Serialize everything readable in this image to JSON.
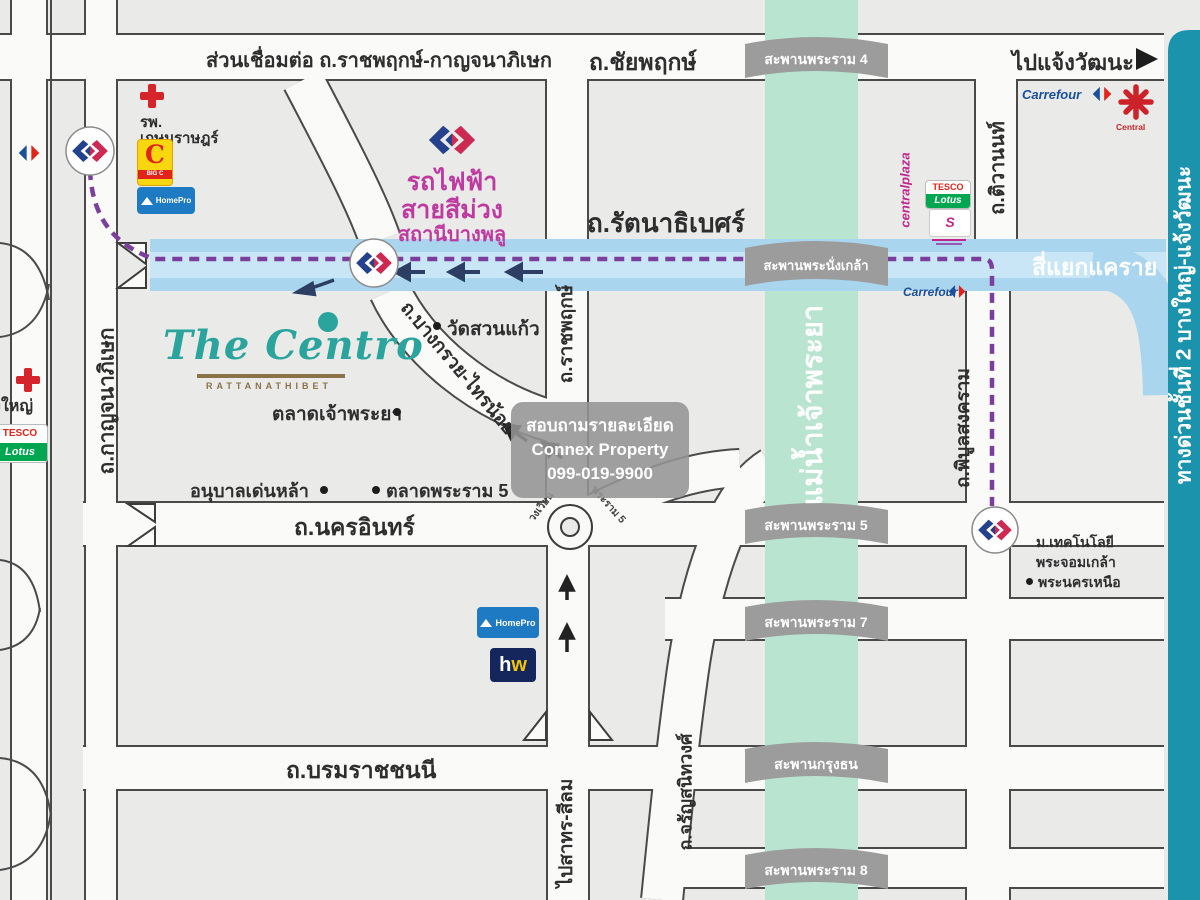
{
  "colors": {
    "river": "#b9e4d0",
    "expressway_band": "#1b93ad",
    "highway_blue": "#a9d5ee",
    "mrt_purple_line": "#7c3e9d",
    "mrt_logo_navy": "#24418e",
    "mrt_logo_red": "#cc2a52",
    "transit_text_magenta": "#bf3aa0",
    "bridge_banner_gray": "#9c9c9c",
    "centro_teal": "#2aa49c",
    "centro_brown": "#8a7248"
  },
  "roads": {
    "connector": "ส่วนเชื่อมต่อ ถ.ราชพฤกษ์-กาญจนาภิเษก",
    "chaiyaphruek": "ถ.ชัยพฤกษ์",
    "to_chaengwattana": "ไปแจ้งวัฒนะ",
    "rattanathibet": "ถ.รัตนาธิเบศร์",
    "tiwanon": "ถ.ติวานนท์",
    "kanchanaphisek": "ถ.กาญจนาภิเษก",
    "ratchaphruek": "ถ.ราชพฤกษ์",
    "bangkruai_sainoi": "ถ.บางกรวย-ไทรน้อย",
    "nakhon_in": "ถ.นครอินทร์",
    "borommaratchachonnani": "ถ.บรมราชชนนี",
    "to_sathorn_silom": "ไปสาทร-สีลม",
    "charansanitwong": "ถ.จรัญสนิทวงศ์",
    "phibunsongkhram": "ถ.พิบูลสงคราม",
    "khae_rai": "สี่แยกแคราย",
    "expressway": "ทางด่วนชั้นที่ 2 บางใหญ่-แจ้งวัฒนะ",
    "river": "แม่น้ำเจ้าพระยา"
  },
  "bridges": {
    "rama4": "สะพานพระราม 4",
    "phranangklao": "สะพานพระนั่งเกล้า",
    "rama5": "สะพานพระราม 5",
    "rama7": "สะพานพระราม 7",
    "krungthon": "สะพานกรุงธน",
    "rama8": "สะพานพระราม 8"
  },
  "transit": {
    "line_name_1": "รถไฟฟ้า",
    "line_name_2": "สายสีม่วง",
    "station": "สถานีบางพลู"
  },
  "project": {
    "name": "The Centro",
    "subtitle": "RATTANATHIBET"
  },
  "places": {
    "kasemrad_1": "รพ.",
    "kasemrad_2": "เกษมราษฎร์",
    "bang_yai": "บางใหญ่",
    "wat_suan_kaew": "วัดสวนแก้ว",
    "talad_chaophraya": "ตลาดเจ้าพระยา",
    "anuban_denla": "อนุบาลเด่นหล้า",
    "talad_rama5": "ตลาดพระราม 5",
    "roundabout_1": "วงเวียน",
    "roundabout_2": "พระราม 5",
    "university_1": "ม.เทคโนโลยี",
    "university_2": "พระจอมเกล้า",
    "university_3": "พระนครเหนือ"
  },
  "logos": {
    "carrefour": "Carrefour",
    "central": "Central",
    "centralplaza": "centralplaza",
    "tesco_1": "TESCO",
    "tesco_2": "Lotus",
    "bigc": "C",
    "bigc_sub": "BIG C",
    "homepro": "HomePro",
    "homeworks_h": "h",
    "homeworks_w": "w"
  },
  "watermark": {
    "line1": "สอบถามรายละเอียด",
    "line2": "Connex Property",
    "line3": "099-019-9900"
  }
}
